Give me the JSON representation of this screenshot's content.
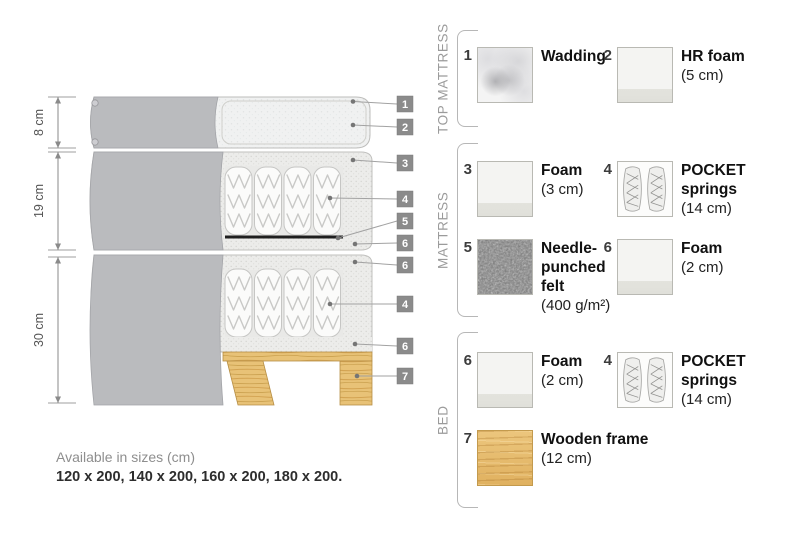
{
  "diagram": {
    "dimensions": [
      {
        "label": "8 cm"
      },
      {
        "label": "19 cm"
      },
      {
        "label": "30 cm"
      }
    ],
    "callouts": [
      "1",
      "2",
      "3",
      "4",
      "5",
      "6",
      "6",
      "4",
      "6",
      "7"
    ]
  },
  "legend": {
    "sections": [
      {
        "title": "TOP MATTRESS",
        "items": [
          {
            "num": "1",
            "bold_lines": [
              "Wadding"
            ],
            "size": "",
            "texture": "wadding"
          },
          {
            "num": "2",
            "bold_lines": [
              "HR foam"
            ],
            "size": "(5 cm)",
            "texture": "foam"
          }
        ]
      },
      {
        "title": "MATTRESS",
        "items": [
          {
            "num": "3",
            "bold_lines": [
              "Foam"
            ],
            "size": "(3 cm)",
            "texture": "foam"
          },
          {
            "num": "4",
            "bold_lines": [
              "POCKET",
              "springs"
            ],
            "size": "(14 cm)",
            "texture": "pocket-springs"
          },
          {
            "num": "5",
            "bold_lines": [
              "Needle-",
              "punched",
              "felt"
            ],
            "size": "(400 g/m²)",
            "texture": "felt"
          },
          {
            "num": "6",
            "bold_lines": [
              "Foam"
            ],
            "size": "(2 cm)",
            "texture": "foam"
          }
        ]
      },
      {
        "title": "BED",
        "items": [
          {
            "num": "6",
            "bold_lines": [
              "Foam"
            ],
            "size": "(2 cm)",
            "texture": "foam"
          },
          {
            "num": "4",
            "bold_lines": [
              "POCKET",
              "springs"
            ],
            "size": "(14 cm)",
            "texture": "pocket-springs"
          },
          {
            "num": "7",
            "bold_lines": [
              "Wooden frame"
            ],
            "size": "(12 cm)",
            "texture": "wood"
          }
        ]
      }
    ]
  },
  "footer": {
    "sizes_title": "Available in sizes (cm)",
    "sizes_list": "120 x 200, 140 x 200, 160 x 200, 180 x 200."
  },
  "colors": {
    "fabric_grey": "#babbbe",
    "quilt_speckle": "#ececea",
    "wood": "#e8c379",
    "felt_grey": "#7a7a7a",
    "callout_square": "#8b8b8b",
    "felt_line": "#1f1f1f"
  }
}
